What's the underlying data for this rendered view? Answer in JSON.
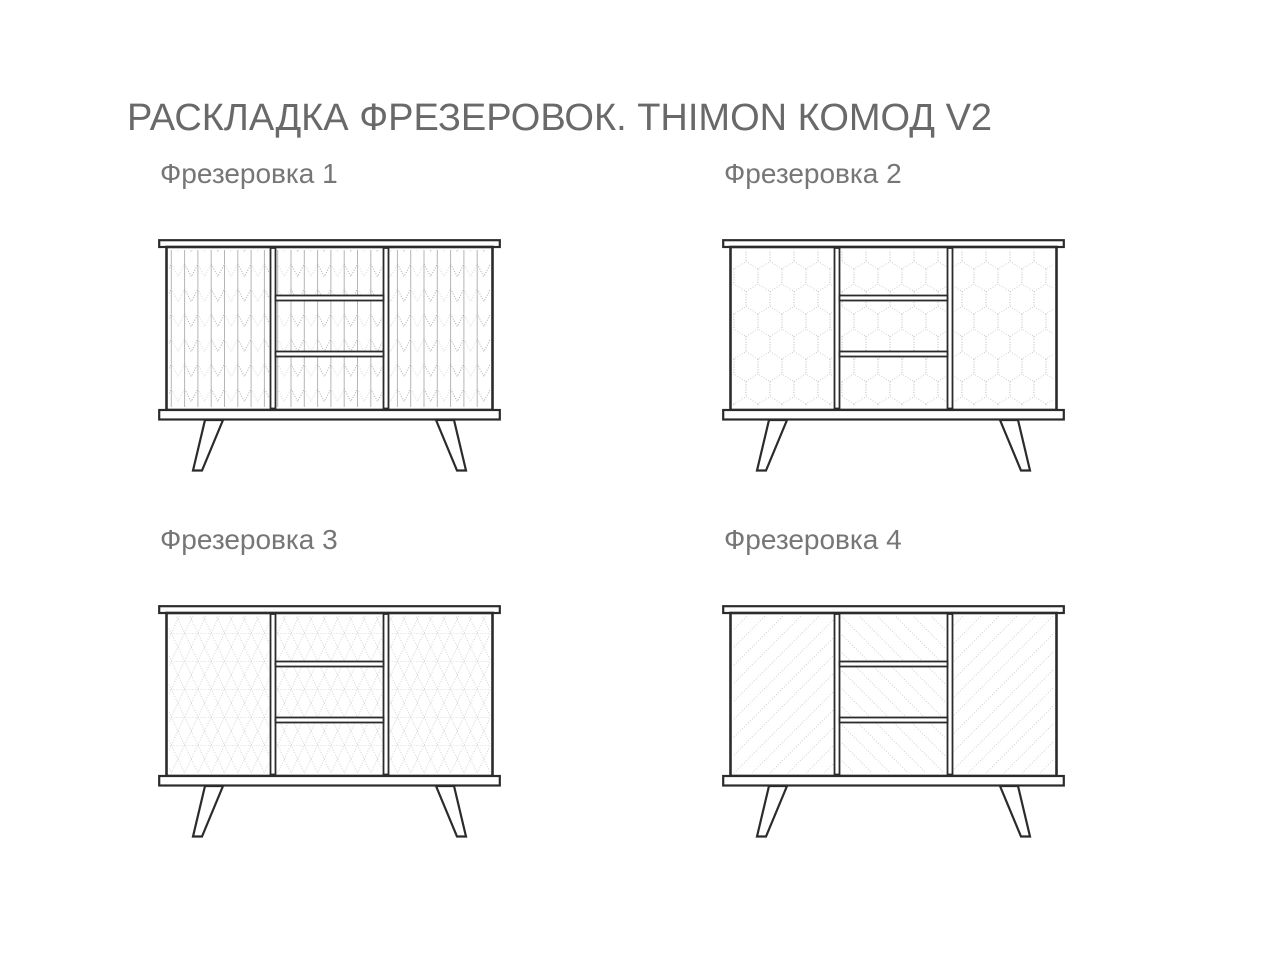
{
  "page": {
    "title": "РАСКЛАДКА ФРЕЗЕРОВОК. THIMON КОМОД V2"
  },
  "colors": {
    "background": "#ffffff",
    "title_text": "#696969",
    "label_text": "#767676",
    "drawing_outline": "#2b2b2b",
    "pattern_line_dark": "#9f9f9f",
    "pattern_line_light": "#d4d4d4",
    "pattern_line_mid": "#c6c6c6"
  },
  "variants": [
    {
      "label": "Фрезеровка 1",
      "pattern_left_door": "herringbone",
      "pattern_drawers": "herringbone",
      "pattern_right_door": "herringbone"
    },
    {
      "label": "Фрезеровка 2",
      "pattern_left_door": "hexagon",
      "pattern_drawers": "hexagon",
      "pattern_right_door": "hexagon"
    },
    {
      "label": "Фрезеровка 3",
      "pattern_left_door": "cube-lattice",
      "pattern_drawers": "cube-lattice",
      "pattern_right_door": "cube-lattice"
    },
    {
      "label": "Фрезеровка 4",
      "pattern_left_door": "diagonal-up",
      "pattern_drawers": "diagonal-down",
      "pattern_right_door": "diagonal-up"
    }
  ],
  "drawing_parts": {
    "structure": [
      "top-board",
      "left-door",
      "drawer-1",
      "drawer-2",
      "drawer-3",
      "right-door",
      "bottom-board",
      "left-leg",
      "right-leg"
    ]
  }
}
